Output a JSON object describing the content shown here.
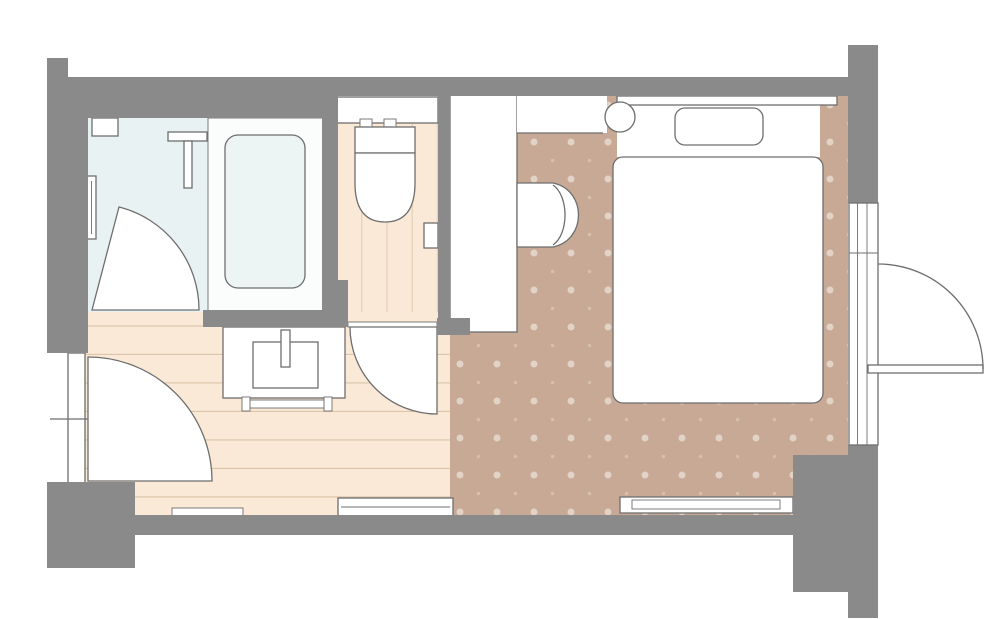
{
  "plan": {
    "kind": "hotel-guest-room-floor-plan",
    "rooms": [
      {
        "name": "bathroom",
        "floor": "bathroom_floor"
      },
      {
        "name": "toilet-room",
        "floor": "wood_floor"
      },
      {
        "name": "entry-hallway",
        "floor": "wood_floor"
      },
      {
        "name": "bedroom",
        "floor": "carpet"
      }
    ],
    "fixtures": [
      "bathtub",
      "shower-head",
      "grab-bar",
      "bathroom-door",
      "wall-niche",
      "toilet",
      "toilet-tank",
      "toilet-paper-holder",
      "toilet-door",
      "washbasin-vanity",
      "basin",
      "faucet",
      "towel-rail",
      "entrance-door",
      "entrance-door-swing",
      "door-threshold",
      "closet",
      "luggage-bench",
      "bedside-table",
      "double-bed",
      "pillow",
      "headboard",
      "floor-unit",
      "balcony-window",
      "balcony-door",
      "balcony-door-swing"
    ]
  },
  "colors": {
    "wall": "#8a8a8a",
    "outline": "#6e6e6e",
    "white": "#ffffff",
    "bathroom_floor": "#e9f2f2",
    "tub_platform": "#fbfdfd",
    "tub_fill": "#edf5f4",
    "wood_floor": "#f9e9d6",
    "plank_line": "#dcc5ab",
    "carpet": "#c7a995",
    "carpet_dot_large": "#e2d3c6",
    "carpet_dot_small": "#d6bfae",
    "page_bg": "#ffffff"
  }
}
